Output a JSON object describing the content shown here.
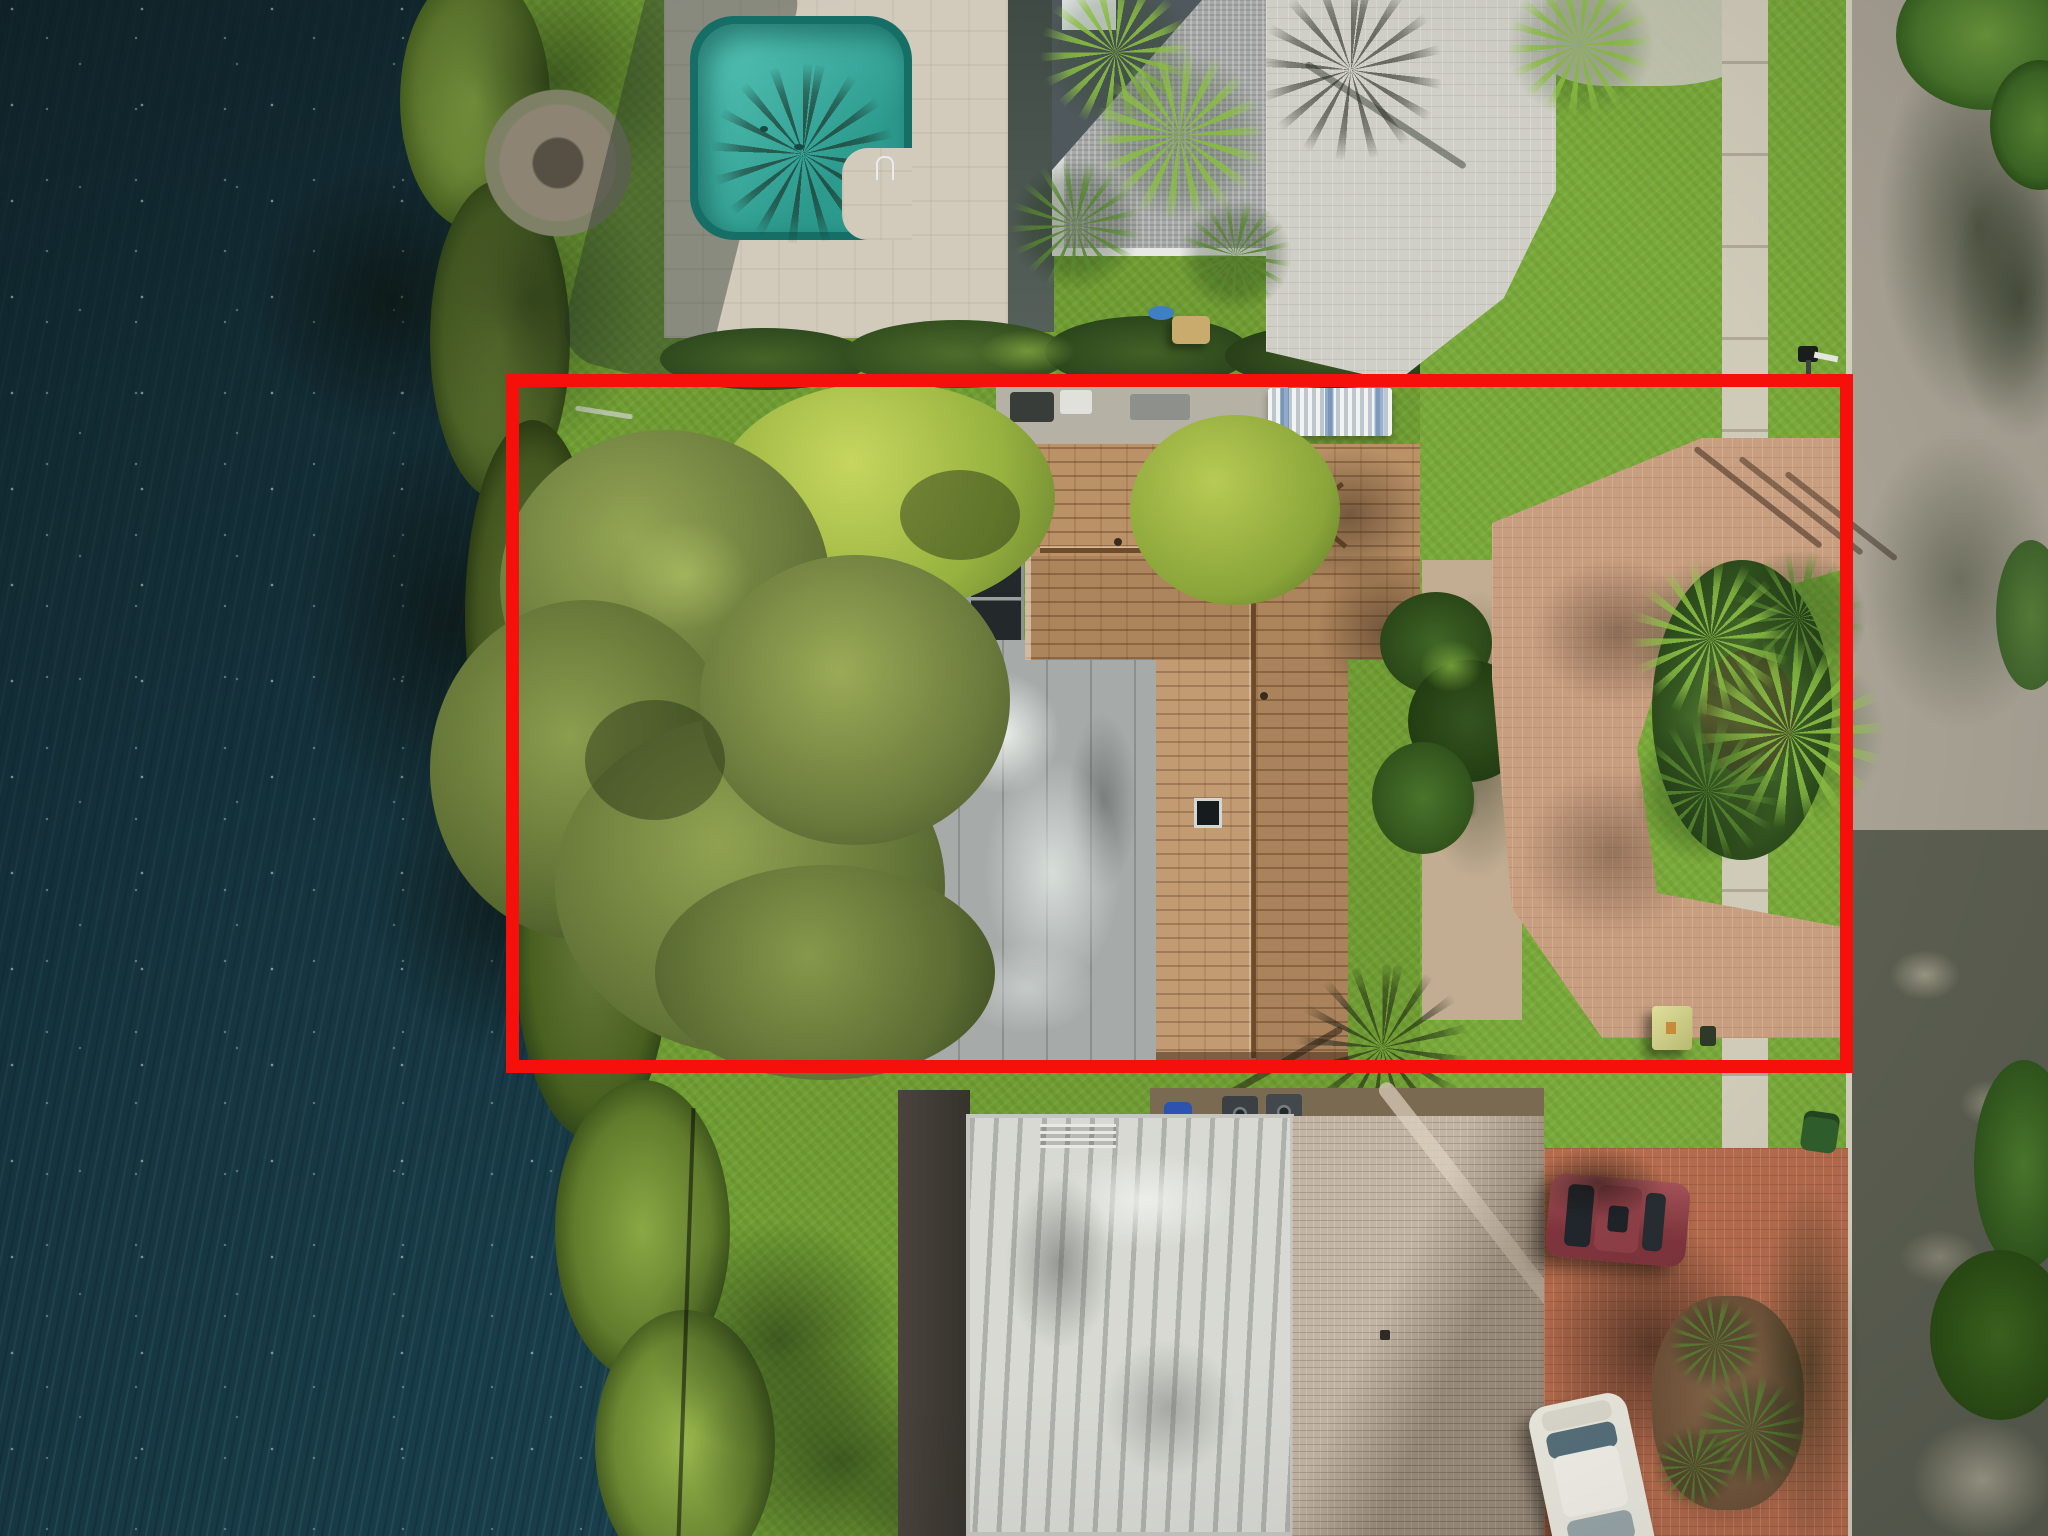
{
  "image": {
    "kind": "aerial-drone-photograph",
    "subject": "Overhead real-estate aerial photo of a waterfront single-family lot outlined with a red boundary rectangle",
    "width_px": 2048,
    "height_px": 1536
  },
  "annotation": {
    "label": "Property boundary highlight",
    "shape": "rectangle",
    "stroke_color": "#f5100c",
    "stroke_width_px": 13,
    "bounds_px": {
      "left": 506,
      "top": 374,
      "width": 1347,
      "height": 699
    }
  },
  "palette": {
    "water_deep": "#142a31",
    "water_ripple": "#2e5560",
    "grass": "#6f9c33",
    "shore_vegetation": "#5d7431",
    "subject_tile_roof": "#bb9268",
    "flat_patio_roof": "#a6abaa",
    "screen_enclosure": "#23282a",
    "pool_water": "#3bb3a4",
    "pool_deck": "#d2cbbc",
    "north_roof_shingle": "#a8aaa9",
    "north_driveway_pavers": "#d0cfc7",
    "subject_driveway_pavers": "#c89e80",
    "south_flat_roof": "#d8d9d3",
    "south_tile_roof": "#b4a492",
    "south_driveway_pavers": "#b56b4d",
    "road_asphalt": "#a8a294",
    "sidewalk": "#d0cab9",
    "boundary_red": "#f5100c",
    "maroon_car": "#7e343c",
    "white_car": "#eceadf",
    "utility_box": "#cfd08a"
  },
  "scene": {
    "water": {
      "label": "Lake with wind ripples and sun sparkles"
    },
    "shoreline": {
      "label": "Vegetated shoreline"
    },
    "subject_property": {
      "label": "Highlighted waterfront property",
      "features": {
        "tile_roof": {
          "label": "Brown barrel-tile hip roof"
        },
        "flat_roof": {
          "label": "Stained flat roof over rear patio"
        },
        "screen_enclosure": {
          "label": "Dark screened enclosure panel"
        },
        "awning": {
          "label": "White corrugated awning"
        },
        "skylight": {
          "label": "Roof skylight"
        },
        "large_tree": {
          "label": "Large olive-green canopy tree"
        },
        "bright_tree": {
          "label": "Bright green canopy tree"
        },
        "circular_driveway": {
          "label": "Curved warm paver driveway"
        },
        "palm_island": {
          "label": "Palm landscape island"
        },
        "utility_box": {
          "label": "Pale green utility box"
        }
      }
    },
    "north_neighbor": {
      "label": "Neighbor to the north",
      "features": {
        "pool": {
          "label": "Teal swimming pool with palm shadow"
        },
        "pool_deck": {
          "label": "Light travertine pool deck"
        },
        "roof": {
          "label": "Gray shingle roof"
        },
        "firepit": {
          "label": "Round stone fire pit patio"
        },
        "driveway": {
          "label": "Gray brick-paver driveway"
        },
        "palms": {
          "label": "Palm trees"
        }
      }
    },
    "south_neighbor": {
      "label": "Neighbor to the south",
      "features": {
        "flat_roof": {
          "label": "White stained flat roof"
        },
        "dark_roof": {
          "label": "Dark shingle roof strip"
        },
        "tile_roof": {
          "label": "Tan tile hip roof"
        },
        "driveway": {
          "label": "Red brick-paver driveway"
        },
        "rooftop_equipment": {
          "label": "AC units and blue barrel"
        }
      },
      "vehicles": [
        {
          "label": "Maroon sedan",
          "color": "#7e343c"
        },
        {
          "label": "White sedan",
          "color": "#eceadf"
        }
      ]
    },
    "street": {
      "label": "Residential street shaded by trees",
      "features": {
        "sidewalk": {
          "label": "Concrete sidewalk"
        },
        "curb": {
          "label": "Curb line"
        },
        "mailbox": {
          "label": "Black mailbox on post"
        }
      }
    }
  }
}
